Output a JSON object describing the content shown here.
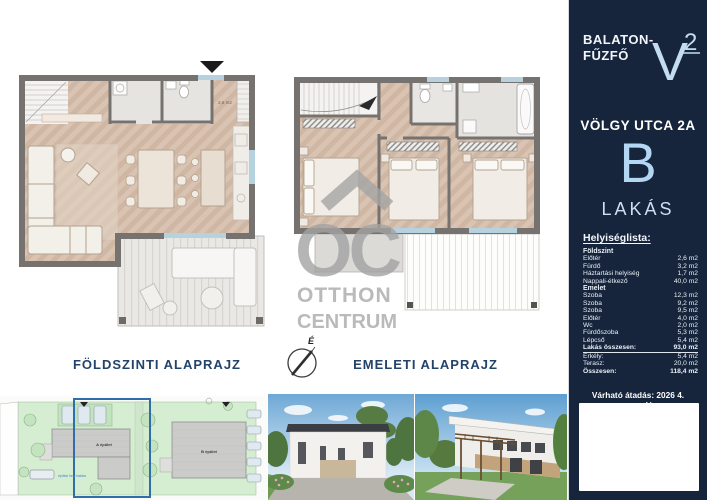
{
  "sidebar": {
    "brand_line1": "BALATON-",
    "brand_line2": "FŰZFŐ",
    "logo": {
      "letter": "V",
      "sup": "2"
    },
    "address": "VÖLGY UTCA 2A",
    "unit": "B",
    "unit_type": "LAKÁS",
    "roomlist_title": "Helyiséglista:",
    "sections": [
      {
        "label": "Földszint",
        "rows": [
          [
            "Előtér",
            "2,6 m2"
          ],
          [
            "Fürdő",
            "3,2 m2"
          ],
          [
            "Háztartási helyiség",
            "1,7 m2"
          ],
          [
            "Nappali-étkező",
            "40,0 m2"
          ]
        ]
      },
      {
        "label": "Emelet",
        "rows": [
          [
            "Szoba",
            "12,3 m2"
          ],
          [
            "Szoba",
            "9,2 m2"
          ],
          [
            "Szoba",
            "9,5 m2"
          ],
          [
            "Előtér",
            "4,0 m2"
          ],
          [
            "Wc",
            "2,0 m2"
          ],
          [
            "Fürdőszoba",
            "5,3 m2"
          ],
          [
            "Lépcső",
            "5,4 m2"
          ]
        ]
      }
    ],
    "totals": [
      {
        "label": "Lakás összesen:",
        "value": "93,0 m2",
        "bold": true,
        "underline": true
      },
      {
        "label": "Erkély:",
        "value": "5,4 m2"
      },
      {
        "label": "Terasz:",
        "value": "20,0 m2"
      },
      {
        "label": "Összesen:",
        "value": "118,4 m2",
        "bold": true
      }
    ],
    "handover": "Várható átadás: 2026 4. negyedév"
  },
  "plans": {
    "ground_label": "FÖLDSZINTI ALAPRAJZ",
    "upper_label": "EMELETI ALAPRAJZ",
    "entry_area": "2,6 m2",
    "compass_north": "É"
  },
  "watermark": {
    "abbr": "OC",
    "line1": "OTTHON",
    "line2": "CENTRUM"
  },
  "siteplan": {
    "building_a": "A épület",
    "building_b": "B épület",
    "boundary_note": "építési hely határa"
  },
  "colors": {
    "sidebar_bg": "#16253c",
    "accent_light_blue": "#b3d6f2",
    "label_navy": "#24436b",
    "plan_wall": "#76726f",
    "wood_floor": "#d9c4b3",
    "highlight_blue": "#2f6dab"
  }
}
